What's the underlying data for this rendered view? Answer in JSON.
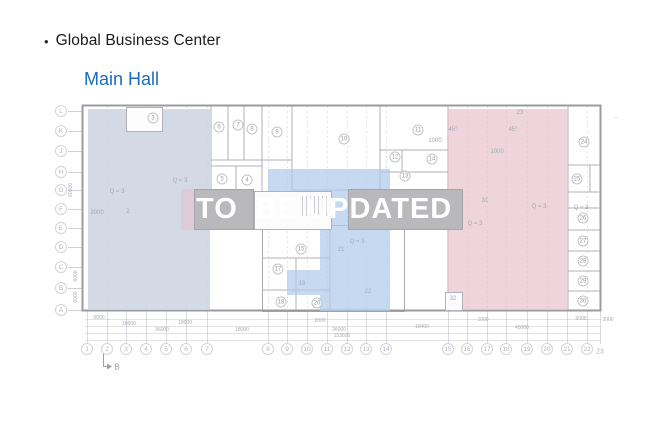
{
  "slide": {
    "bullet": "•",
    "title": "Global Business Center",
    "subtitle": "Main Hall",
    "watermark": "TO  BE UPDATED"
  },
  "colors": {
    "title_text": "#1a1a1a",
    "subtitle_blue": "#1d6abe",
    "watermark_text": "#ffffff",
    "zone_left": "rgba(203,212,224,0.85)",
    "zone_middle": "rgba(178,202,235,0.72)",
    "zone_right": "rgba(231,192,204,0.68)",
    "zone_fragment": "rgba(231,192,204,0.55)",
    "gray_block": "#b9b9bc"
  },
  "plan": {
    "row_labels": [
      {
        "t": "L",
        "y": 111
      },
      {
        "t": "K",
        "y": 131
      },
      {
        "t": "J",
        "y": 151
      },
      {
        "t": "H",
        "y": 172
      },
      {
        "t": "G",
        "y": 190
      },
      {
        "t": "F",
        "y": 209
      },
      {
        "t": "E",
        "y": 228
      },
      {
        "t": "D",
        "y": 247
      },
      {
        "t": "C",
        "y": 267
      },
      {
        "t": "B",
        "y": 288
      },
      {
        "t": "A",
        "y": 310
      }
    ],
    "col_labels": [
      {
        "t": "1",
        "x": 87
      },
      {
        "t": "2",
        "x": 107
      },
      {
        "t": "3",
        "x": 126
      },
      {
        "t": "4",
        "x": 146
      },
      {
        "t": "5",
        "x": 166
      },
      {
        "t": "6",
        "x": 186
      },
      {
        "t": "7",
        "x": 207
      },
      {
        "t": "8",
        "x": 268
      },
      {
        "t": "9",
        "x": 287
      },
      {
        "t": "10",
        "x": 307
      },
      {
        "t": "11",
        "x": 327
      },
      {
        "t": "12",
        "x": 347
      },
      {
        "t": "13",
        "x": 366
      },
      {
        "t": "14",
        "x": 386
      },
      {
        "t": "15",
        "x": 448
      },
      {
        "t": "16",
        "x": 467
      },
      {
        "t": "17",
        "x": 487
      },
      {
        "t": "18",
        "x": 506
      },
      {
        "t": "19",
        "x": 527
      },
      {
        "t": "20",
        "x": 547
      },
      {
        "t": "21",
        "x": 567
      },
      {
        "t": "22",
        "x": 587
      }
    ],
    "col_label_plain": {
      "t": "23",
      "x": 600,
      "y": 352
    },
    "rooms": [
      {
        "n": "3",
        "x": 153,
        "y": 118
      },
      {
        "n": "6",
        "x": 219,
        "y": 127
      },
      {
        "n": "7",
        "x": 238,
        "y": 125
      },
      {
        "n": "8",
        "x": 252,
        "y": 129
      },
      {
        "n": "9",
        "x": 277,
        "y": 132
      },
      {
        "n": "10",
        "x": 344,
        "y": 139
      },
      {
        "n": "11",
        "x": 418,
        "y": 130
      },
      {
        "n": "12",
        "x": 395,
        "y": 157
      },
      {
        "n": "14",
        "x": 432,
        "y": 159
      },
      {
        "n": "13",
        "x": 405,
        "y": 176
      },
      {
        "n": "5",
        "x": 222,
        "y": 179
      },
      {
        "n": "4",
        "x": 247,
        "y": 180
      },
      {
        "n": "15",
        "x": 301,
        "y": 249
      },
      {
        "n": "17",
        "x": 278,
        "y": 269
      },
      {
        "n": "18",
        "x": 281,
        "y": 302
      },
      {
        "n": "20",
        "x": 317,
        "y": 303
      },
      {
        "n": "24",
        "x": 584,
        "y": 142
      },
      {
        "n": "25",
        "x": 577,
        "y": 179
      },
      {
        "n": "26",
        "x": 583,
        "y": 218
      },
      {
        "n": "27",
        "x": 583,
        "y": 241
      },
      {
        "n": "28",
        "x": 583,
        "y": 261
      },
      {
        "n": "29",
        "x": 583,
        "y": 281
      },
      {
        "n": "30",
        "x": 583,
        "y": 301
      }
    ],
    "texts": [
      {
        "t": "Q = 3",
        "x": 180,
        "y": 181
      },
      {
        "t": "Q = 3",
        "x": 117,
        "y": 192
      },
      {
        "t": "Q = 3",
        "x": 357,
        "y": 242
      },
      {
        "t": "Q = 3",
        "x": 475,
        "y": 224
      },
      {
        "t": "Q = 3",
        "x": 539,
        "y": 207
      },
      {
        "t": "Q = 3",
        "x": 581,
        "y": 208
      },
      {
        "t": "2",
        "x": 128,
        "y": 212
      },
      {
        "t": "2000",
        "x": 97,
        "y": 213
      },
      {
        "t": "19",
        "x": 302,
        "y": 284
      },
      {
        "t": "21",
        "x": 341,
        "y": 250
      },
      {
        "t": "22",
        "x": 368,
        "y": 292
      },
      {
        "t": "31",
        "x": 485,
        "y": 201
      },
      {
        "t": "32",
        "x": 453,
        "y": 299
      },
      {
        "t": "23",
        "x": 520,
        "y": 113
      },
      {
        "t": "45°",
        "x": 453,
        "y": 130
      },
      {
        "t": "45°",
        "x": 513,
        "y": 130
      },
      {
        "t": "1000",
        "x": 435,
        "y": 141
      },
      {
        "t": "1000",
        "x": 497,
        "y": 152
      },
      {
        "t": "-",
        "x": 616,
        "y": 118
      }
    ],
    "dims_bottom": [
      {
        "t": "6000",
        "x": 99,
        "y": 318
      },
      {
        "t": "18000",
        "x": 129,
        "y": 324
      },
      {
        "t": "18000",
        "x": 185,
        "y": 323
      },
      {
        "t": "36000",
        "x": 162,
        "y": 330
      },
      {
        "t": "18000",
        "x": 242,
        "y": 330
      },
      {
        "t": "2000",
        "x": 320,
        "y": 321
      },
      {
        "t": "36000",
        "x": 339,
        "y": 330
      },
      {
        "t": "153600",
        "x": 342,
        "y": 336
      },
      {
        "t": "1000",
        "x": 483,
        "y": 320
      },
      {
        "t": "18400",
        "x": 422,
        "y": 327
      },
      {
        "t": "45000",
        "x": 522,
        "y": 328
      },
      {
        "t": "6000",
        "x": 581,
        "y": 319
      },
      {
        "t": "3000",
        "x": 608,
        "y": 320
      }
    ],
    "dims_left": [
      {
        "t": "60000",
        "x": 71,
        "y": 190
      },
      {
        "t": "6000",
        "x": 76,
        "y": 276
      },
      {
        "t": "6000",
        "x": 76,
        "y": 297
      }
    ],
    "section_marker": {
      "t": "B",
      "x": 117,
      "y": 367
    }
  }
}
